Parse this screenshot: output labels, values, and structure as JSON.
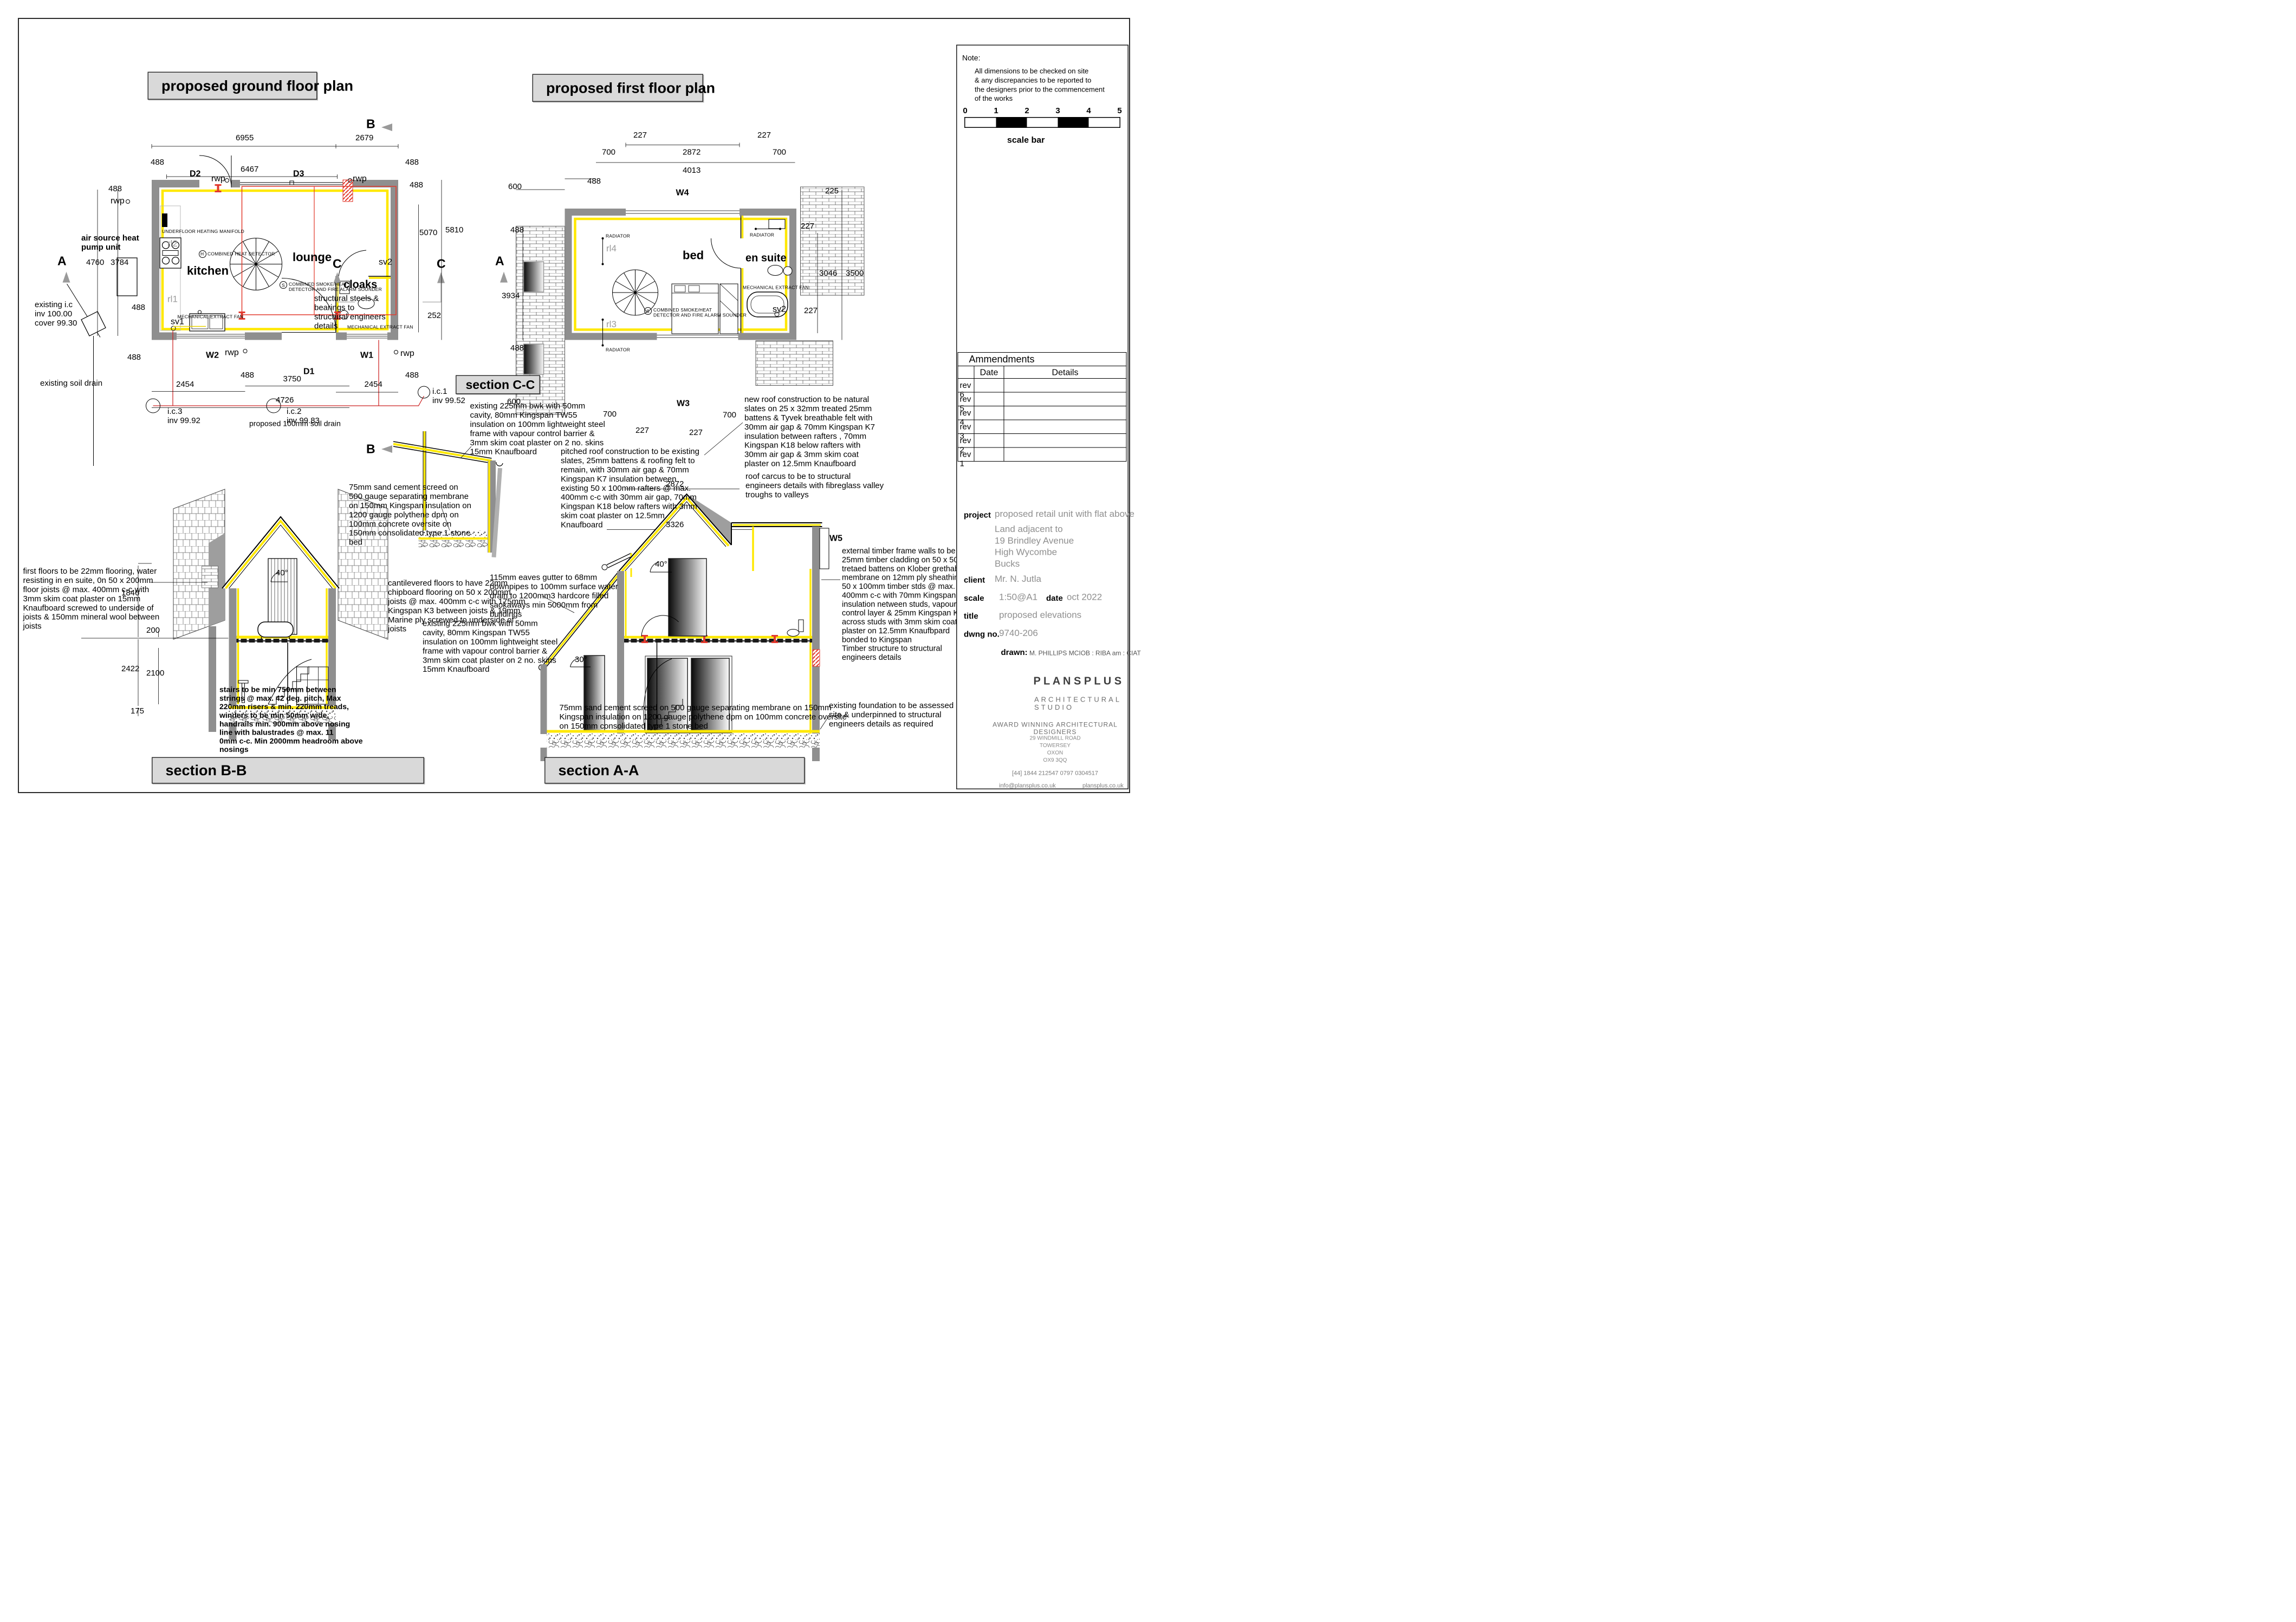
{
  "titles": {
    "ground": "proposed ground floor plan",
    "first": "proposed first floor plan",
    "section_cc": "section C-C",
    "section_bb": "section B-B",
    "section_aa": "section A-A"
  },
  "panel": {
    "note_label": "Note:",
    "note_body": "All dimensions to be checked on site\n& any discrepancies to be reported to\nthe designers prior to the commencement\nof the works",
    "scale_ticks": [
      "0",
      "1",
      "2",
      "3",
      "4",
      "5"
    ],
    "scale_label": "scale bar",
    "amendments": {
      "title": "Ammendments",
      "col_date": "Date",
      "col_details": "Details",
      "rows": [
        "rev 6",
        "rev 5",
        "rev 4",
        "rev 3",
        "rev 2",
        "rev 1"
      ]
    },
    "labels": {
      "project": "project",
      "client": "client",
      "scale": "scale",
      "date": "date",
      "title": "title",
      "dwng": "dwng no.",
      "drawn": "drawn:"
    },
    "values": {
      "project_name": "proposed retail unit with flat above",
      "project_address": "Land adjacent to\n19 Brindley Avenue\nHigh Wycombe\nBucks",
      "client": "Mr. N. Jutla",
      "scale": "1:50@A1",
      "date": "oct 2022",
      "title": "proposed elevations",
      "dwng": "9740-206",
      "drawn": "M. PHILLIPS  MCIOB : RIBA am : CIAT"
    },
    "firm": {
      "name": "P L A N S P L U S",
      "studio": "ARCHITECTURAL STUDIO",
      "award": "AWARD WINNING ARCHITECTURAL DESIGNERS",
      "address": "29 WINDMILL ROAD\nTOWERSEY\nOXON\nOX9 3QQ",
      "phones": "[44]  1844 212547          0797 0304517",
      "email": "info@plansplus.co.uk",
      "web": "plansplus.co.uk"
    }
  },
  "rooms": {
    "kitchen": "kitchen",
    "lounge": "lounge",
    "cloaks": "cloaks",
    "bed": "bed",
    "ensuite": "en suite"
  },
  "refs": {
    "d1": "D1",
    "d2": "D2",
    "d3": "D3",
    "w1": "W1",
    "w2": "W2",
    "w3": "W3",
    "w4": "W4",
    "w5": "W5",
    "sv1": "sv1",
    "sv2": "sv2",
    "rl1": "rl1",
    "rl2": "rl2",
    "rl3": "rl3",
    "rl4": "rl4",
    "rwp": "rwp",
    "a": "A",
    "b": "B",
    "c": "C",
    "s": "S",
    "h": "H"
  },
  "dims": {
    "v488": "488",
    "v6955": "6955",
    "v2679": "2679",
    "v6467": "6467",
    "v5070": "5070",
    "v5810": "5810",
    "v252": "252",
    "v4760": "4760",
    "v3784": "3784",
    "v2454": "2454",
    "v3750": "3750",
    "v4726": "4726",
    "v227": "227",
    "v700": "700",
    "v2872": "2872",
    "v4013": "4013",
    "v225": "225",
    "v600": "600",
    "v600d": "600.",
    "v3934": "3934",
    "v3326": "3326",
    "v3046": "3046",
    "v3500": "3500",
    "v1846": "1846",
    "v200": "200",
    "v2422": "2422",
    "v2100": "2100",
    "v175": "175",
    "v40": "40°",
    "v30": "30°"
  },
  "ann": {
    "heat_pump": "air source heat\npump unit",
    "underfloor": "UNDERFLOOR HEATING MANIFOLD",
    "heat_det": "COMBINED HEAT DETECTOR",
    "smoke": "COMBINED SMOKE/HEAT\nDETECTOR AND FIRE ALARM SOUNDER",
    "mef": "MECHANICAL EXTRACT FAN",
    "radiator": "RADIATOR",
    "steels": "structural steels &\nbearings to\nstructural engineers\ndetails",
    "existing_ic": "existing i.c\ninv  100.00\ncover 99.30",
    "existing_soil": "existing soil drain",
    "ic3": "i.c.3\ninv 99.92",
    "ic2": "i.c.2\ninv 99.83",
    "ic1": "i.c.1\ninv 99.52",
    "proposed_soil": "proposed 100mm soil drain",
    "cc_bwk": "existing 225mm bwk with 50mm\ncavity, 80mm Kingspan TW55\ninsulation on 100mm lightweight steel\nframe with vapour control barrier &\n3mm skim coat plaster on 2 no. skins\n15mm Knaufboard",
    "cc_pitched": "pitched roof construction to be existing\nslates, 25mm battens & roofing felt to\nremain, with 30mm air gap & 70mm\nKingspan K7 insulation between\nexisting 50 x 100mm rafters @ max.\n400mm c-c with 30mm air gap, 70mm\nKingspan K18 below rafters with 3mm\nskim coat plaster on 12.5mm\nKnaufboard",
    "cc_screed": "75mm sand cement screed on\n500 gauge separating membrane\non 150mm Kingspan insulation on\n1200 gauge polythene dpm on\n100mm concrete oversite on\n150mm consolidated type 1 stone\nbed",
    "cc_cantilever": "cantilevered floors to have 22mm\nchipboard flooring on 50 x 200mm\njoists @ max. 400mm c-c with 175mm\nKingspan K3 between joists & 19mm\nMarine ply screwed to underside of\njoists",
    "cc_eaves": "115mm eaves gutter to 68mm\ndownpipes to 100mm surface water\ndrain to 1200mm3 hardcore filled\nsaokaways min 5000mm from\nbuildings",
    "ff_newroof": "new roof construction to be natural\nslates on 25 x 32mm  treated  25mm\nbattens & Tyvek breathable felt  with\n30mm air gap & 70mm Kingspan K7\ninsulation between  rafters , 70mm\nKingspan K18 below rafters with\n30mm air gap & 3mm skim coat\nplaster on 12.5mm Knaufboard",
    "ff_carcus": "roof carcus to be to structural\nengineers details with fibreglass valley\ntroughs to valleys",
    "bb_floors": "first floors to be 22mm flooring, water\nresisting in en suite, 0n 50 x 200mm\nfloor joists @ max. 400mm c-c with\n3mm skim coat plaster on 15mm\nKnaufboard screwed to underside of\njoists & 150mm mineral wool between\njoists",
    "bb_stairs": "stairs to be min 750mm between\nstrings @ max. 42 deg. pitch, Max\n220mm risers & min. 220mm treads,\nwinders to be min 50mm wide,\nhandrails min. 900mm above nosing\nline with balustrades @ max. 11\n0mm c-c. Min 2000mm headroom above\nnosings",
    "aa_timber": "external timber frame walls to be\n25mm timber cladding on 50 x 50mm\ntretaed battens on Klober grethable\nmembrane on 12mm ply sheathing on\n50 x 100mm timber stds @ max.\n400mm c-c with 70mm Kingspan K12\ninsulation netween studs, vapour\ncontrol layer & 25mm Kingspan K18\nacross studs with 3mm skim coat\nplaster on 12.5mm Knaufbpard\nbonded to Kingspan\nTimber structure to structural\nengineers details",
    "aa_screed": "75mm sand cement screed on 500 gauge separating membrane on 150mm\nKingspan insulation on 1200 gauge polythene dpm on 100mm concrete oversite\non 150mm consolidated type 1 stone bed",
    "aa_foundation": "existing foundation to be assessed on\nsite & underpinned to structural\nengineers details as required"
  }
}
